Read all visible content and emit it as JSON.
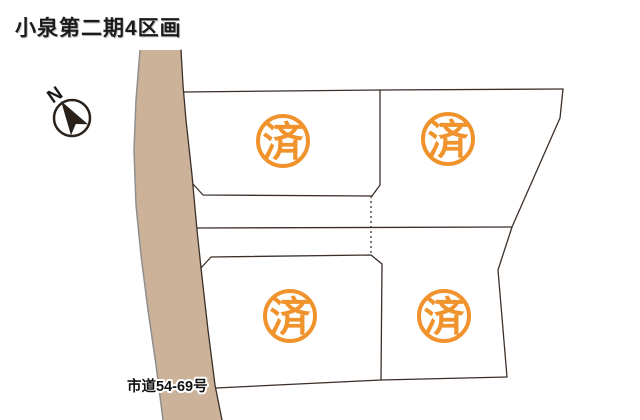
{
  "title": "小泉第二期4区画",
  "compass": {
    "label": "N"
  },
  "road": {
    "label": "市道54-69号"
  },
  "lots": [
    {
      "name": "top-left-lot",
      "stamp": "済"
    },
    {
      "name": "top-right-lot",
      "stamp": "済"
    },
    {
      "name": "bottom-left-lot",
      "stamp": "済"
    },
    {
      "name": "bottom-right-lot",
      "stamp": "済"
    }
  ],
  "colors": {
    "stamp": "#f0932d",
    "road_fill": "#cbb298",
    "line": "#3b2f28"
  }
}
